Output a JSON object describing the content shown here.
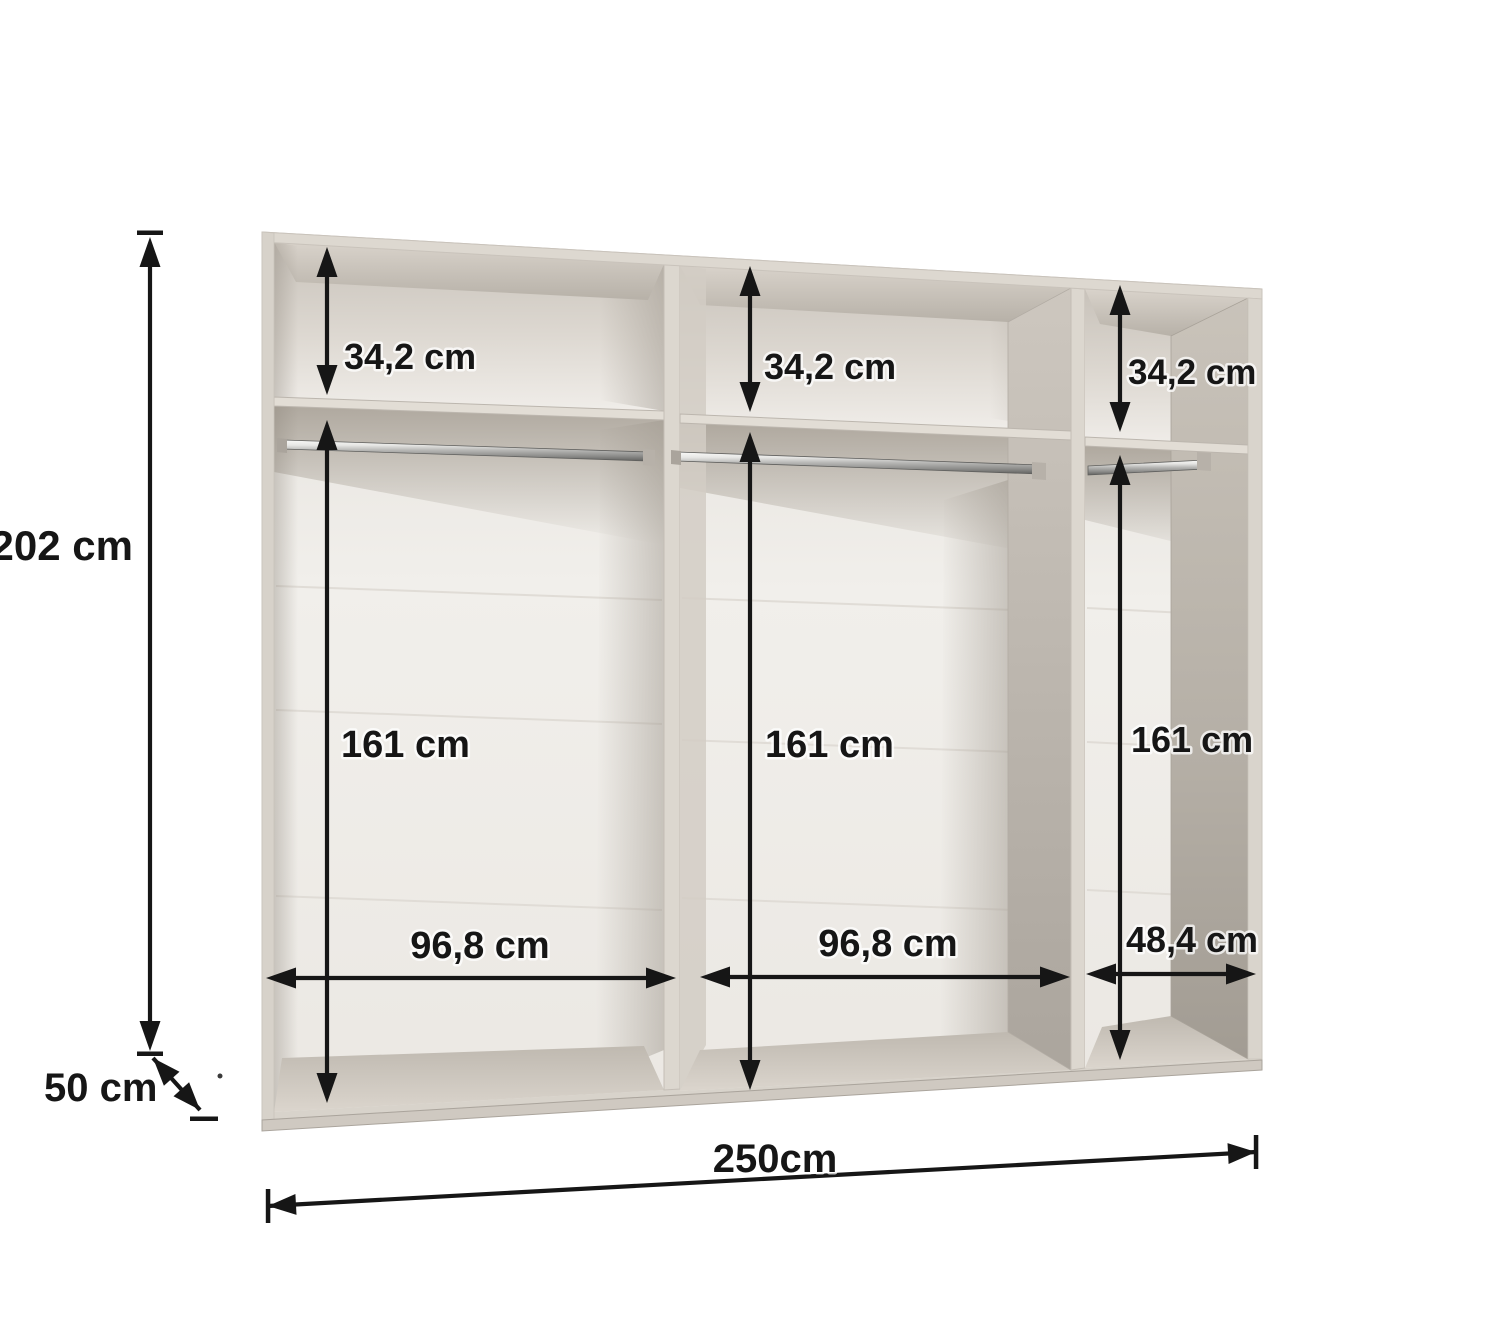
{
  "figure": {
    "type": "wardrobe-interior-dimension-diagram",
    "background": "#ffffff",
    "annotation_color": "#161616",
    "palette": {
      "panel_front_face": "#dcd7cf",
      "ceiling_front": "#d9d3cb",
      "ceiling_back": "#b7b1a8",
      "cubby_back_wall_shadow": "#c8c2ba",
      "back_wall": "#f1efeb",
      "floor_front": "#dbd5cd",
      "floor_back": "#c0bab1",
      "side_face_light": "#cdc7bf",
      "side_face_dark": "#a29c93",
      "rail_highlight": "#fafaf8",
      "rail_shadow": "#626260"
    }
  },
  "dimensions": {
    "height": {
      "label": "202 cm",
      "value_cm": 202
    },
    "depth": {
      "label": "50 cm",
      "value_cm": 50
    },
    "width": {
      "label": "250cm",
      "value_cm": 250
    },
    "compartments": [
      {
        "name": "left",
        "top_shelf_height": {
          "label": "34,2 cm",
          "value_cm": 34.2
        },
        "hanging_height": {
          "label": "161 cm",
          "value_cm": 161
        },
        "inner_width": {
          "label": "96,8 cm",
          "value_cm": 96.8
        }
      },
      {
        "name": "middle",
        "top_shelf_height": {
          "label": "34,2 cm",
          "value_cm": 34.2
        },
        "hanging_height": {
          "label": "161 cm",
          "value_cm": 161
        },
        "inner_width": {
          "label": "96,8 cm",
          "value_cm": 96.8
        }
      },
      {
        "name": "right",
        "top_shelf_height": {
          "label": "34,2 cm",
          "value_cm": 34.2
        },
        "hanging_height": {
          "label": "161 cm",
          "value_cm": 161
        },
        "inner_width": {
          "label": "48,4 cm",
          "value_cm": 48.4
        }
      }
    ]
  }
}
